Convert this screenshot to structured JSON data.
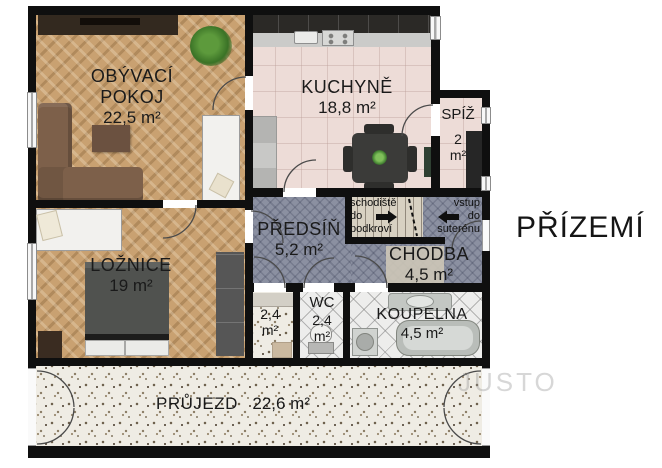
{
  "floor_title": "PŘÍZEMÍ",
  "watermark": "JUSTO",
  "rooms": {
    "living": {
      "line1": "OBÝVACÍ",
      "line2": "POKOJ",
      "area": "22,5 m²"
    },
    "kitchen": {
      "name": "KUCHYNĚ",
      "area": "18,8 m²"
    },
    "pantry": {
      "name": "SPÍŽ",
      "area_value": "2",
      "area_unit": "m²"
    },
    "hall": {
      "name": "PŘEDSÍŇ",
      "area": "5,2 m²"
    },
    "corridor": {
      "name": "CHODBA",
      "area": "4,5 m²"
    },
    "bedroom": {
      "name": "LOŽNICE",
      "area": "19 m²"
    },
    "storage": {
      "area_value": "2,4",
      "area_unit": "m²"
    },
    "wc": {
      "name": "WC",
      "area_value": "2,4",
      "area_unit": "m²"
    },
    "bathroom": {
      "name": "KOUPELNA",
      "area": "4,5 m²"
    },
    "passage": {
      "name": "PRŮJEZD",
      "area": "22,6 m²"
    }
  },
  "annotations": {
    "stairs": {
      "line1": "schodiště",
      "line2": "do",
      "line3": "podkroví"
    },
    "entry": {
      "line1": "vstup",
      "line2": "do",
      "line3": "suterénu"
    }
  },
  "colors": {
    "wall": "#0f0f0f",
    "wood": "#c9a171",
    "kitchen_floor": "#eddcd7",
    "carpet": "#8b90a1",
    "tile": "#ededec",
    "terrazzo": "#efece4",
    "mat": "#d8d1c2",
    "sofa": "#7d604a",
    "dark_furniture": "#2b2521",
    "text": "#1a1a1a"
  }
}
